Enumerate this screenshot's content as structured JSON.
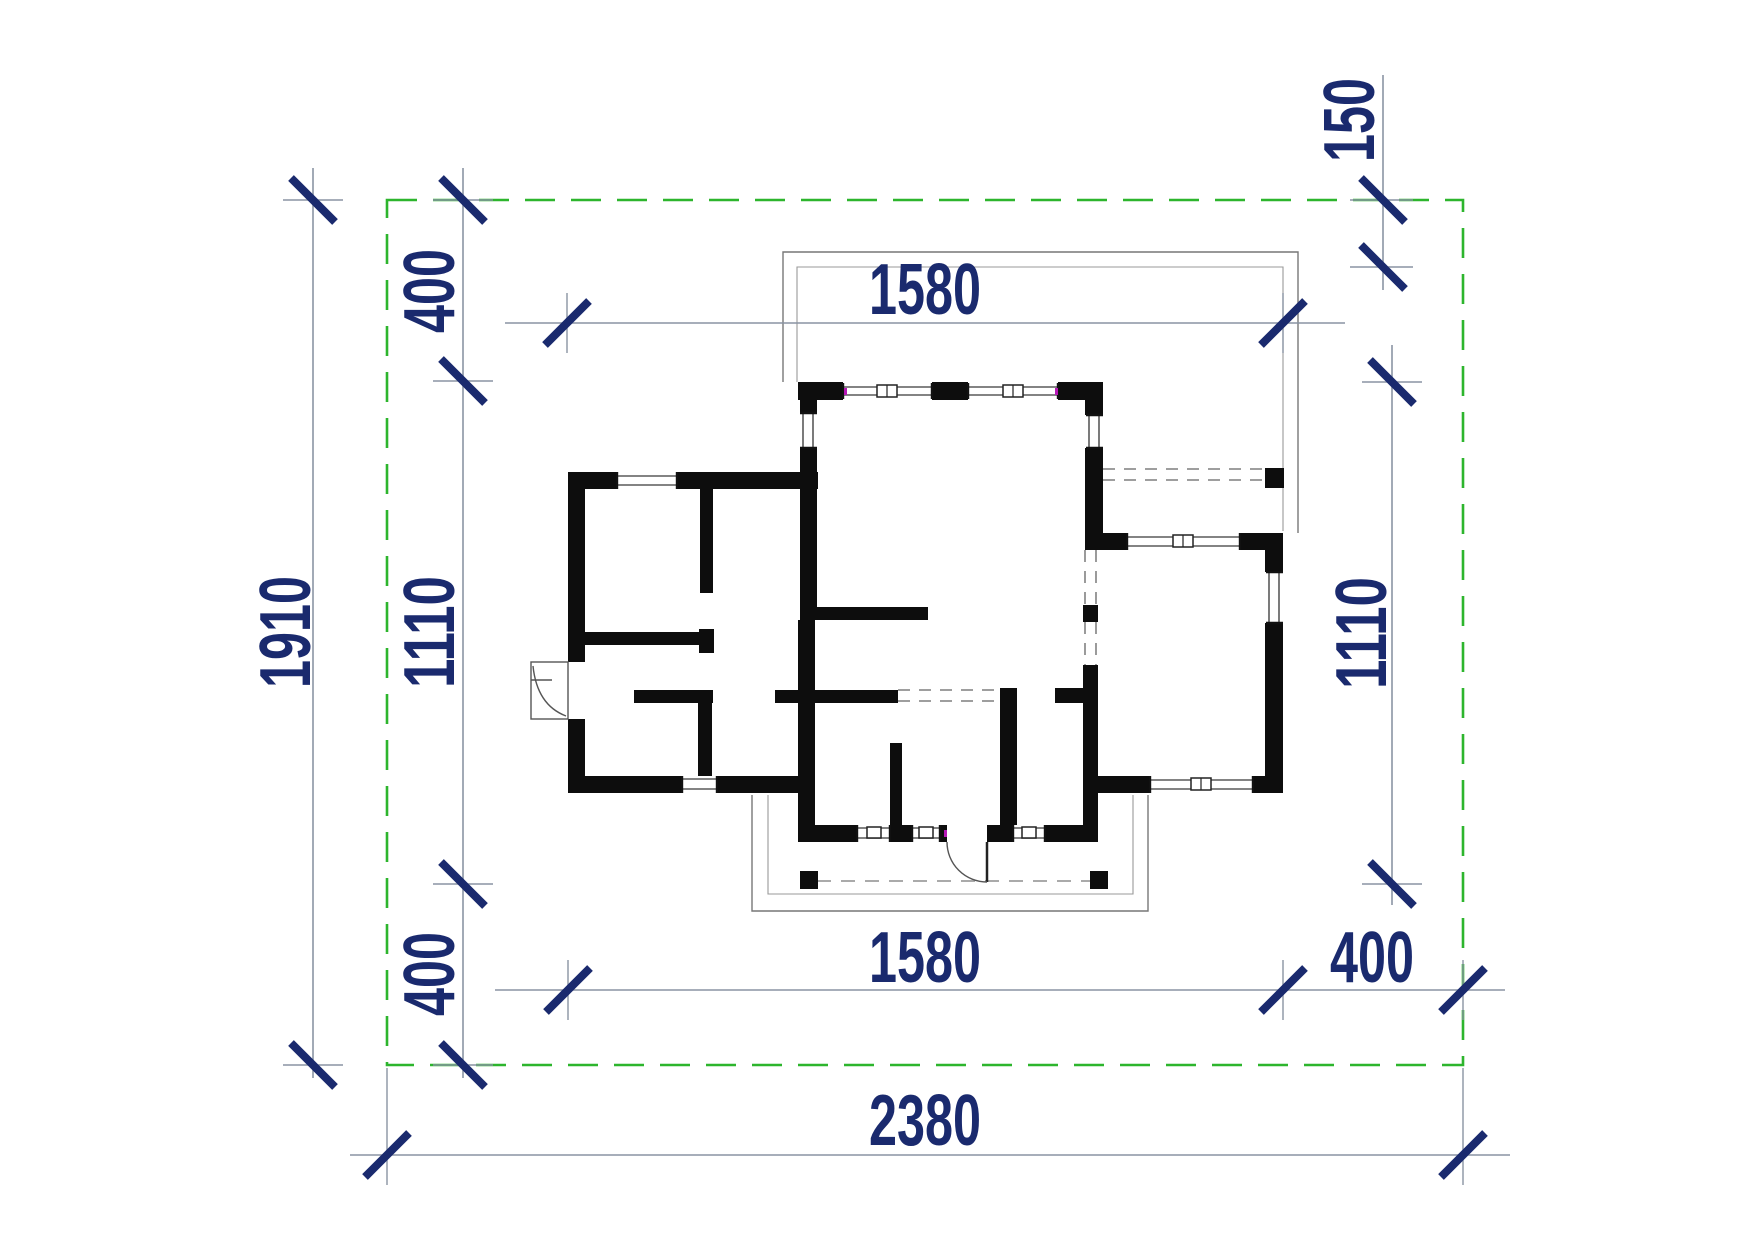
{
  "colors": {
    "green": "#2db52d",
    "navy": "#1a2a6e",
    "wall": "#0d0d0d",
    "gray": "#8a94a3"
  },
  "dims": {
    "site_width": "2380",
    "site_depth": "1910",
    "top_width": "1580",
    "bottom_width": "1580",
    "left_depth": "1110",
    "right_depth": "1110",
    "setback_top_left": "400",
    "setback_bottom_left": "400",
    "setback_bottom_right": "400",
    "setback_top_right": "150"
  }
}
